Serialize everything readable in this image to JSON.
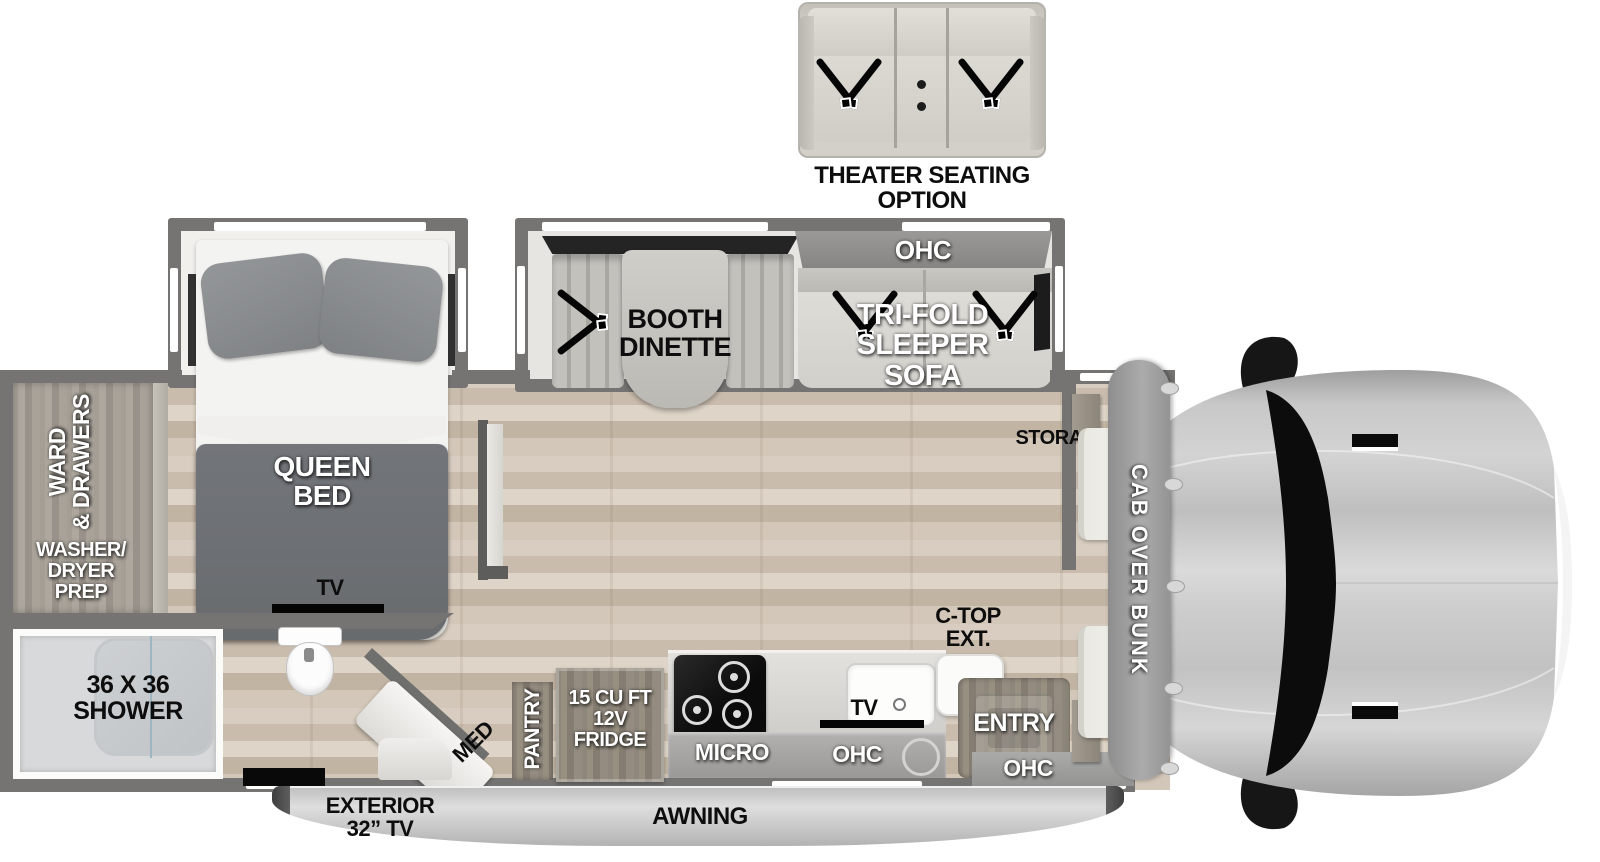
{
  "colors": {
    "wall": "#757473",
    "floor_wood": "#d0c4b6",
    "interior_light": "#efeeec",
    "furniture": "#d8d6d1",
    "ohc_band": "#909090",
    "bed_dark": "#6d7073",
    "cab_body": "#c6c6c6",
    "windshield": "#0c0c0c",
    "label_black": "#0d0d0d",
    "label_white": "#ffffff"
  },
  "optional_furniture": {
    "label_line1": "THEATER SEATING",
    "label_line2": "OPTION"
  },
  "slideouts": {
    "bedroom": {
      "bed_line1": "QUEEN",
      "bed_line2": "BED"
    },
    "living": {
      "ohc": "OHC",
      "sofa_line1": "TRI-FOLD",
      "sofa_line2": "SLEEPER",
      "sofa_line3": "SOFA",
      "dinette_line1": "BOOTH",
      "dinette_line2": "DINETTE"
    }
  },
  "rooms": {
    "wardrobe": {
      "ward_line1": "WARD",
      "ward_line2": "& DRAWERS",
      "prep_line1": "WASHER/",
      "prep_line2": "DRYER",
      "prep_line3": "PREP"
    },
    "bath": {
      "shower_line1": "36 X 36",
      "shower_line2": "SHOWER",
      "tv": "TV",
      "med": "MED"
    },
    "kitchen": {
      "pantry": "PANTRY",
      "fridge_line1": "15 CU FT",
      "fridge_line2": "12V",
      "fridge_line3": "FRIDGE",
      "micro": "MICRO",
      "ohc": "OHC",
      "tv": "TV",
      "ctop_line1": "C-TOP",
      "ctop_line2": "EXT."
    },
    "entry": {
      "label": "ENTRY",
      "ohc": "OHC"
    },
    "front": {
      "storage": "STORAGE",
      "bunk": "CAB OVER BUNK"
    }
  },
  "exterior": {
    "tv_line1": "EXTERIOR",
    "tv_line2": "32” TV",
    "awning": "AWNING"
  }
}
